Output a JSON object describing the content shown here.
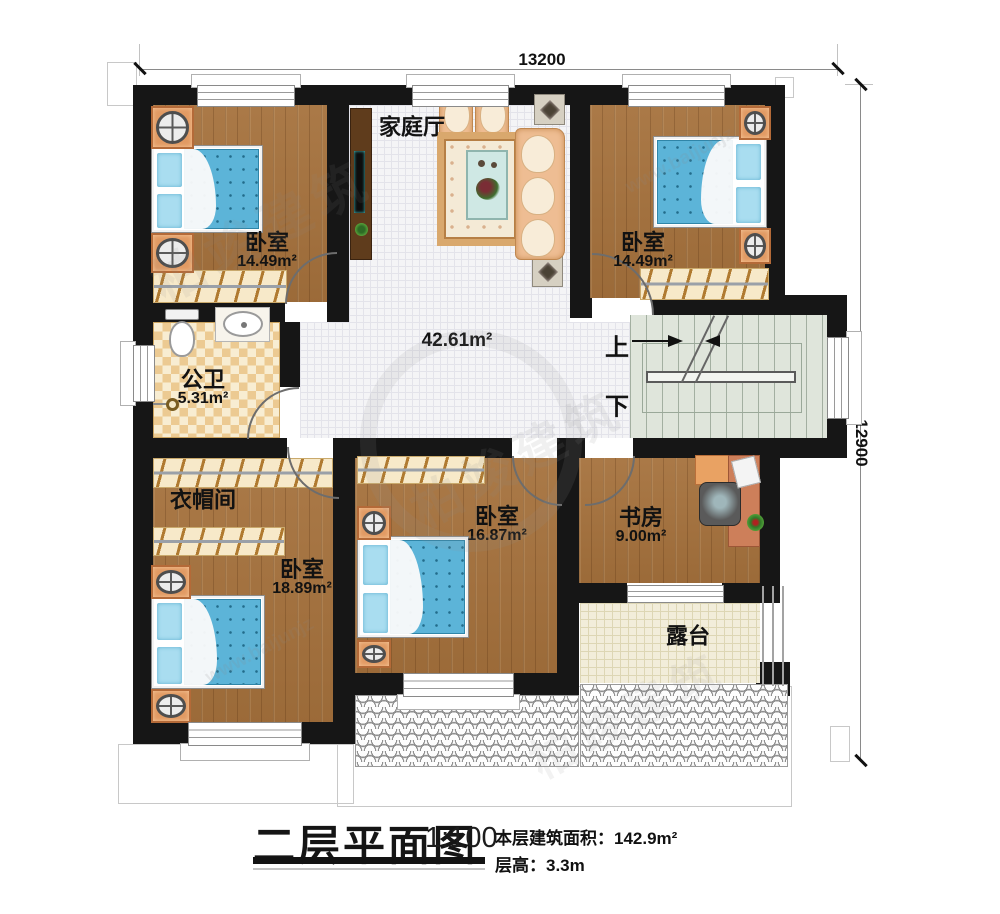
{
  "dimensions": {
    "width_mm": "13200",
    "height_mm": "12900"
  },
  "rooms": {
    "bedroom_top_left": {
      "name": "卧室",
      "area": "14.49m²"
    },
    "family_hall": {
      "name": "家庭厅"
    },
    "bedroom_top_right": {
      "name": "卧室",
      "area": "14.49m²"
    },
    "bathroom": {
      "name": "公卫",
      "area": "5.31m²"
    },
    "hall": {
      "area": "42.61m²"
    },
    "cloakroom": {
      "name": "衣帽间"
    },
    "bedroom_bottom_left": {
      "name": "卧室",
      "area": "18.89m²"
    },
    "bedroom_bottom_middle": {
      "name": "卧室",
      "area": "16.87m²"
    },
    "study": {
      "name": "书房",
      "area": "9.00m²"
    },
    "terrace": {
      "name": "露台"
    }
  },
  "stairs": {
    "up_label": "上",
    "down_label": "下"
  },
  "title_block": {
    "title": "二层平面图",
    "scale": "1:100",
    "floor_area_label": "本层建筑面积：",
    "floor_area_value": "142.9m²",
    "floor_height_label": "层高：",
    "floor_height_value": "3.3m"
  },
  "watermark": {
    "brand": "柏竣建筑",
    "site": "www.baijunjz"
  }
}
